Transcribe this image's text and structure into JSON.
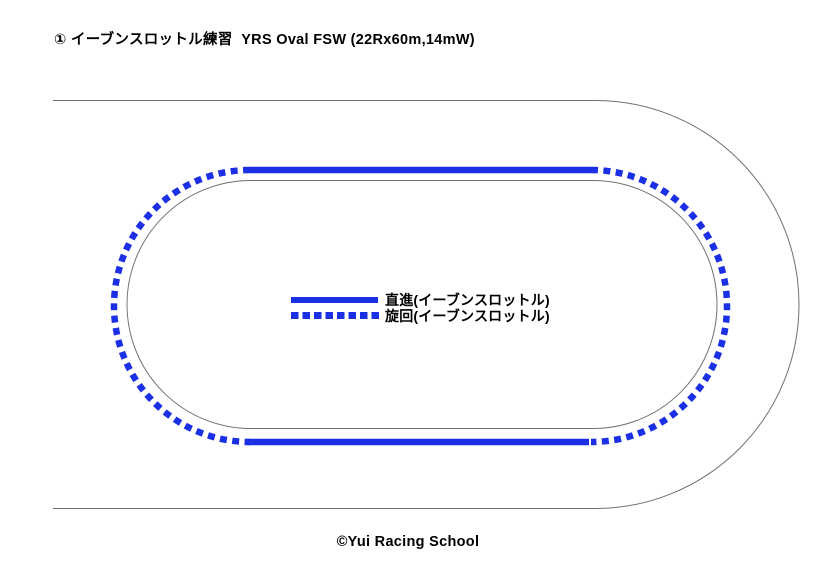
{
  "page": {
    "title": "① イーブンスロットル練習  YRS Oval FSW (22Rx60m,14mW)",
    "copyright": "©Yui Racing School",
    "background": "#ffffff"
  },
  "legend": {
    "items": [
      {
        "style": "solid",
        "label": "直進(イーブンスロットル)"
      },
      {
        "style": "dotted",
        "label": "旋回(イーブンスロットル)"
      }
    ]
  },
  "colors": {
    "driving_line_blue": "#1b30e4",
    "track_outline_gray": "#707070",
    "text_black": "#000000"
  }
}
